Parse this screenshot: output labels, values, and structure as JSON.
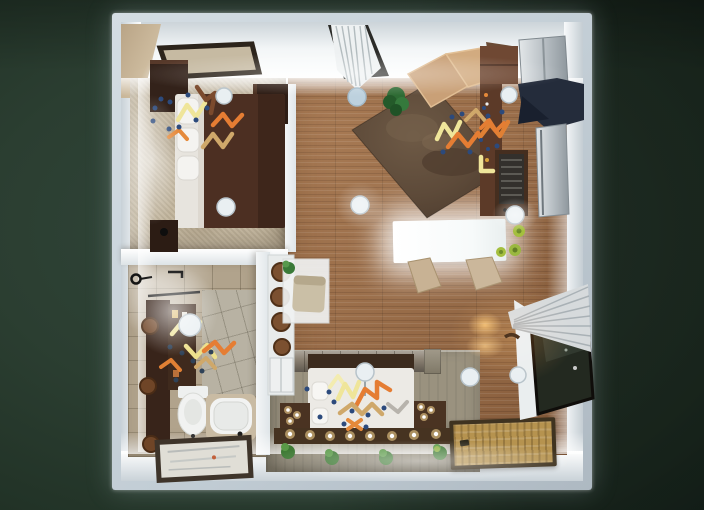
{
  "view": {
    "type": "3d-floorplan-render-top-view",
    "description": "Top-down 3D render of a studio apartment floor plan on a dark green backdrop"
  },
  "palette": {
    "background": "#2b3e31",
    "wall_band": "#c7d1d9",
    "wall_face": "#f2f5f6",
    "wood_floor": "#9c6b45",
    "bedroom_carpet": "#c2b59d",
    "bathroom_tile": "#b1a38c",
    "shower_tile": "#b8b2a3",
    "concrete_platform": "#9a927f",
    "stone_wall": "#8b8173",
    "island_counter": "#fbfdfd",
    "area_rug": "#5d4a39",
    "sofa_tan": "#c9a077",
    "sofa_brown": "#8f6a4c",
    "bed_duvet_brown": "#4c2f22",
    "zen_bed_white": "#eceae5",
    "woven_mat": "#b6934f",
    "curtain_gray": "#d6dadc",
    "glass_door": "#232920",
    "appliance_metal": "#b9c0c5",
    "hood_navy": "#242c3b",
    "decal_orange": "#e57d33",
    "decal_yellow": "#efe59a",
    "decal_tan": "#cfa86a",
    "decal_brown": "#7b4a2d",
    "decal_dot_blue": "#2c4a7c",
    "plant_dark_green": "#2e6b34",
    "plant_lime": "#a4bf3e"
  },
  "rooms": [
    {
      "id": "bedroom",
      "position": "top-left",
      "floor": "beige carpet",
      "items": [
        "wall art frame",
        "dresser",
        "double bed with brown duvet",
        "white pillows",
        "nightstand",
        "corner cabinet",
        "2 ceiling light discs",
        "zigzag decals with blue dots"
      ]
    },
    {
      "id": "living-room",
      "position": "top-center",
      "floor": "wood planks",
      "items": [
        "window with white curtain",
        "hanging lamp disc",
        "sectional sofa (tan and brown)",
        "dark brown area rug (rotated)",
        "potted plant",
        "ceiling light disc",
        "zigzag decals with blue dots"
      ]
    },
    {
      "id": "kitchen",
      "position": "top-right",
      "floor": "wood planks",
      "items": [
        "upper cabinet",
        "refrigerator",
        "navy range hood",
        "counter strip",
        "stove with grill",
        "stainless unit",
        "glowing island counter",
        "2 bar chairs",
        "3 lime potted herbs",
        "2 ceiling light discs",
        "zigzag decals"
      ]
    },
    {
      "id": "hallway",
      "position": "center-left",
      "floor": "wood planks",
      "items": [
        "white shelf with 4 wicker baskets",
        "glass-door lower cabinet",
        "white desk",
        "tan chair",
        "desk plant"
      ]
    },
    {
      "id": "bathroom",
      "position": "bottom-left",
      "floor": "stone tile",
      "items": [
        "towel ring",
        "towel hooks",
        "towel bar",
        "dark vanity column",
        "3 round wicker plates",
        "shelf with bottles",
        "toilet",
        "bathtub with deck",
        "framed floor mat",
        "ceiling light disc",
        "zigzag decals"
      ]
    },
    {
      "id": "zen-bedroom",
      "position": "bottom-center",
      "floor": "concrete platform",
      "items": [
        "stone headboard wall",
        "dark headboard band",
        "white platform bed",
        "pillows",
        "bed lamp disc with stem",
        "2 candle side shelves",
        "candle foot shelf with 8 tea lights",
        "4 green plants",
        "zigzag decals with blue dots"
      ]
    },
    {
      "id": "entry",
      "position": "bottom-right",
      "floor": "wood planks",
      "items": [
        "tied gray curtain",
        "dark glass balcony door",
        "white door jamb",
        "black door handle",
        "woven bamboo mat",
        "2 warm wall light glows",
        "2 ceiling light discs"
      ]
    }
  ],
  "counts": {
    "ceiling_light_discs": 10,
    "zigzag_decal_clusters": 5,
    "candle_tea_lights": 14,
    "plants": 9,
    "windows": 2
  }
}
